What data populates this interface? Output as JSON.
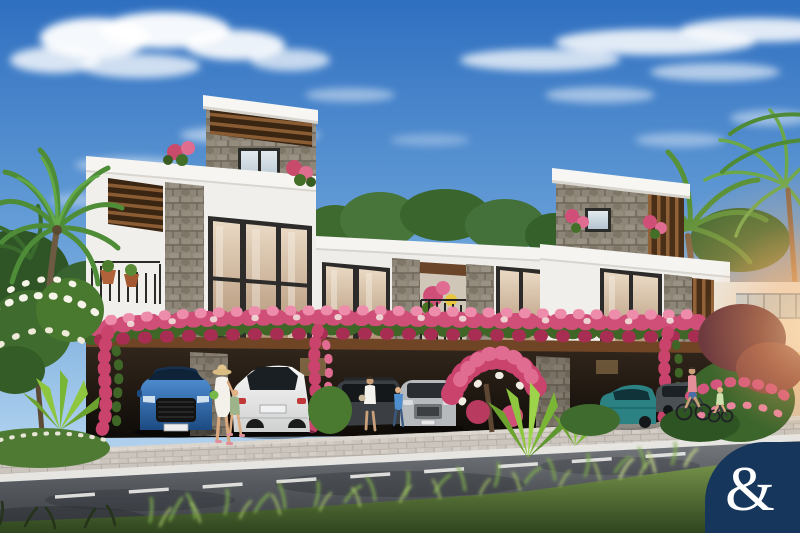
{
  "meta": {
    "type": "photorealistic architectural render",
    "subject": "Modern stone-and-white townhouse row with bougainvillea carport, palms, street scene",
    "width_px": 800,
    "height_px": 533
  },
  "watermark": {
    "ampersand": "&",
    "background_color": "#16365c",
    "text_color": "#ffffff",
    "shape": "rounded-corner wedge, bottom-right"
  },
  "palette": {
    "sky_top": "#2f6fc0",
    "sky_horizon": "#cfe2f2",
    "wall_white": "#f1efeb",
    "stone": "#8d8678",
    "wood": "#7a4d2a",
    "bougainvillea": "#cf4f78",
    "foliage": "#4a7a30",
    "road": "#54585c",
    "paver": "#cbc5bd",
    "sun_glow": "#ffb066"
  },
  "scene": {
    "sky": "blue sky with wispy white clouds",
    "buildings": [
      {
        "name": "left-townhouse",
        "features": "rooftop stone tower with wood pergola, curtained glass wall, wood slat screen, balcony planters"
      },
      {
        "name": "middle-townhouse",
        "features": "balcony with black railing and flower pots between stone piers, warm-lit windows"
      },
      {
        "name": "right-townhouse",
        "features": "stone and wood rooftop tower, tall window, glass balcony, palms behind with sun glow"
      }
    ],
    "carport": "shared shaded carport draped in pink bougainvillea over a timber fascia",
    "vehicles": [
      {
        "name": "blue-suv",
        "color": "#2a5f9e",
        "view": "front"
      },
      {
        "name": "white-suv",
        "color": "#efefed",
        "view": "rear"
      },
      {
        "name": "dark-gray-suv",
        "color": "#3b3f43",
        "view": "front"
      },
      {
        "name": "silver-suv",
        "color": "#b7babc",
        "view": "front"
      },
      {
        "name": "teal-sedan",
        "color": "#2c8183",
        "view": "rear-side"
      },
      {
        "name": "gray-hatchback",
        "color": "#4b5054",
        "view": "side"
      }
    ],
    "people": [
      {
        "name": "woman-with-sunhat",
        "detail": "white dress, straw hat, green bag, walking with child"
      },
      {
        "name": "child-walking",
        "detail": "sage green outfit, pink sandals"
      },
      {
        "name": "woman-shopper",
        "detail": "white top, dark shorts, walking"
      },
      {
        "name": "child-in-blue",
        "detail": "blue outfit near silver SUV"
      },
      {
        "name": "man-cycling",
        "detail": "pink shirt, blue shorts"
      },
      {
        "name": "child-cycling",
        "detail": "light green top, small bike"
      }
    ],
    "vegetation": [
      "coconut-palms",
      "plumeria-with-white-flowers",
      "agave",
      "bougainvillea",
      "ornamental-grasses",
      "red-leaf-tree"
    ],
    "road": {
      "surface": "asphalt with tree shadows",
      "center_line": "white dashed",
      "curb": "light concrete",
      "foreground": "blurred sunlit grass verge"
    }
  }
}
